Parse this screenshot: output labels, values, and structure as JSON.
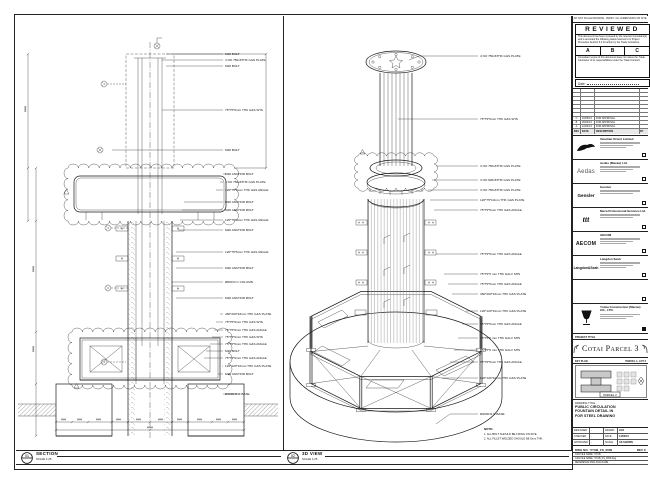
{
  "sheet": {
    "top_note": "DO NOT SCALE DRAWING. VERIFY ALL DIMENSIONS ON SITE."
  },
  "captions": {
    "section": {
      "bubble": "01",
      "title": "SECTION",
      "scale": "SCALE 1:25"
    },
    "iso": {
      "bubble": "02",
      "title": "3D VIEW",
      "scale": "SCALE 1:25"
    }
  },
  "section": {
    "labels": [
      "M20 BOLT",
      "4 NO 750x6THK G&S PLATE",
      "M20 BOLT",
      "75*75*6mm THK G&S SHS",
      "M20 BOLT",
      "M20 ANCHOR BOLT",
      "4 NO 750x6THK G&S PLATE",
      "120*75*6mm THK G&S ANGLE",
      "M20 ANCHOR BOLT",
      "M20 ANCHOR BOLT",
      "120*75*6mm THK G&S ANGLE",
      "M20 ANCHOR BOLT",
      "120*75*6mm THK G&S ANGLE",
      "M20 ANCHOR BOLT",
      "Ø600 R.C COLUMN",
      "M20 ANCHOR BOLT",
      "460*200*16mm THK G&S PLATE",
      "75*75*6mm THK G&S SHS",
      "75*75*6mm THK G&S ANGLE",
      "75*75*6mm THK G&S SHS",
      "75*75*6mm THK G&S ANGLE",
      "M20 BOLT",
      "75*75*6mm THK G&S ANGLE",
      "120*120*10mm THK G&S PLATE",
      "M20 ANCHOR BOLT",
      "Ø4000 R.C BASE"
    ]
  },
  "iso": {
    "labels": [
      "4 NO 750x6THK G&S PLATE",
      "75*75*6mm THK G&S SHS",
      "4 NO 750x6THK G&S PLATE",
      "4 NO 600x6THK G&S PLATE",
      "4 NO 750x6THK G&S PLATE",
      "120*75*10mm THK G&S PLATE",
      "75*75*6mm THK G&S ANGLE",
      "75*75*6mm THK G&S ANGLE",
      "75*75*6 mm THK GALV SHS",
      "75*75*6mm THK G&S ANGLE",
      "460*200*16mm THK G&S PLATE",
      "120*120*10mm THK G&S PLATE",
      "75*75*6mm THK G&S ANGLE",
      "75*75*6 mm THK GALV SHS",
      "75*75*6 mm THK GALV SHS",
      "75*75*6mm THK G&S ANGLE",
      "120*120*10mm THK G&S PLATE",
      "Ø4000 R.C BASE"
    ],
    "note_title": "NOTE:",
    "notes": [
      "1. ALL BOLT SHOULD BE FIXING ON SITE.",
      "2. ALL FILLET WELDED SHOULD BE 6mm THK."
    ]
  },
  "stamp": {
    "title": "REVIEWED",
    "body1": "This document has been reviewed by the relevant Consultant(s) and is accorded the following status referred to in Project Procedure Section 5.4 for action by the Trade Contractor.",
    "options": [
      "A",
      "B",
      "C"
    ],
    "body2": "Consultant review of this document does not relieve the Trade Contractor of its responsibilities under the Trade Contract.",
    "date_label": "Date :"
  },
  "revisions": {
    "header": {
      "rev": "REV",
      "date": "DATE",
      "desc": "DESCRIPTION",
      "by": "BY"
    },
    "rows": [
      {
        "rev": "C",
        "date": "10/05/13",
        "desc": "FOR APPROVAL",
        "by": ""
      },
      {
        "rev": "B",
        "date": "26/04/13",
        "desc": "FOR APPROVAL",
        "by": ""
      },
      {
        "rev": "A",
        "date": "12/04/13",
        "desc": "FOR APPROVAL",
        "by": ""
      }
    ]
  },
  "consultants": [
    {
      "name": "Venetian Orient Limited",
      "logo_text": ""
    },
    {
      "name": "Aedas (Macau) Ltd.",
      "logo_text": "Aedas"
    },
    {
      "name": "Gensler",
      "logo_text": "Gensler"
    },
    {
      "name": "Meca Professional Services Ltd.",
      "logo_text": "ttt"
    },
    {
      "name": "AECOM",
      "logo_text": "AECOM"
    },
    {
      "name": "Langdon Seah",
      "logo_text": "Langdon&Seah"
    }
  ],
  "contractor": {
    "name": "Yodea Construction (Macau) CO., LTD."
  },
  "project": {
    "label": "PROJECT TITLE",
    "title": "Cotai Parcel 3"
  },
  "keyplan": {
    "label": "KEY PLAN",
    "right": "PARCEL 1, LOT 2",
    "tag": "PARCEL 3"
  },
  "titleblock": {
    "drawing_title_label": "DRAWING TITLE :",
    "title_lines": [
      "PUBLIC CIRCULATION",
      "FOUNTAIN DETAIL IN",
      "FOR STEEL DRAWING"
    ],
    "fields": {
      "rows": [
        {
          "l1": "DESIGNED",
          "v1": "-",
          "l2": "DRAWN",
          "v2": "LEO"
        },
        {
          "l1": "CHECKED",
          "v1": "-",
          "l2": "DATE",
          "v2": "14/03/13"
        },
        {
          "l1": "APPROVED",
          "v1": "-",
          "l2": "SCALE",
          "v2": "AS SHOWN"
        }
      ]
    },
    "dwg_label": "DWG NO : 5YUB_FS_0000",
    "rev_label": "REV  C",
    "cad1": "CAD FILE NAME : 5YUB",
    "cad2": "CAD FILE NAME : 5YUB_FS_0000.dwg",
    "cad3": "REFERENCE DWG FILE NAME :"
  }
}
